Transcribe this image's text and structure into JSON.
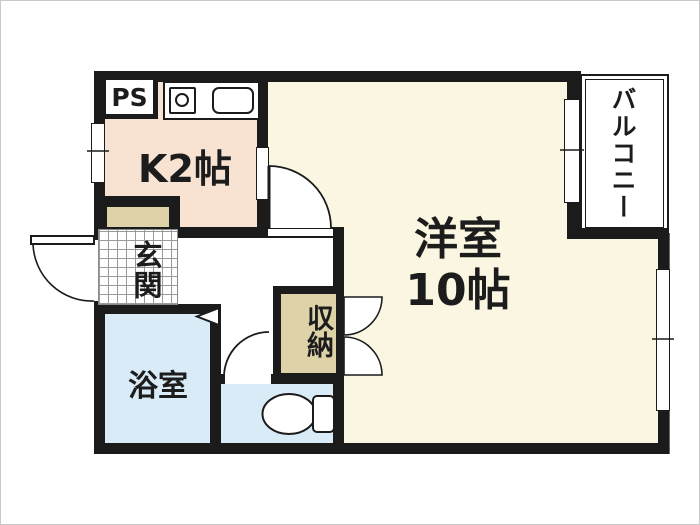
{
  "floorplan": {
    "labels": {
      "pipe_space": "PS",
      "kitchen": "K2帖",
      "entrance": "玄関",
      "bathroom": "浴室",
      "storage": "収納",
      "western_room_name": "洋室",
      "western_room_size": "10帖",
      "balcony": "バルコニー"
    },
    "colors": {
      "wall": "#1b1b1b",
      "kitchen_fill": "#f8e3d3",
      "western_room_fill": "#fbf6e1",
      "bathroom_fill": "#d9ebf7",
      "toilet_fill": "#d9ebf7",
      "storage_fill": "#ded3a8",
      "cabinet_fill": "#ded3a8",
      "balcony_fill": "#ffffff",
      "tile_grid": "#9a9a9a",
      "frame": "#c9c9c9"
    },
    "icons": {
      "stove": "stove-burner-icon",
      "sink": "sink-icon",
      "toilet": "toilet-icon",
      "bath_door": "folding-door-triangle-icon"
    }
  }
}
